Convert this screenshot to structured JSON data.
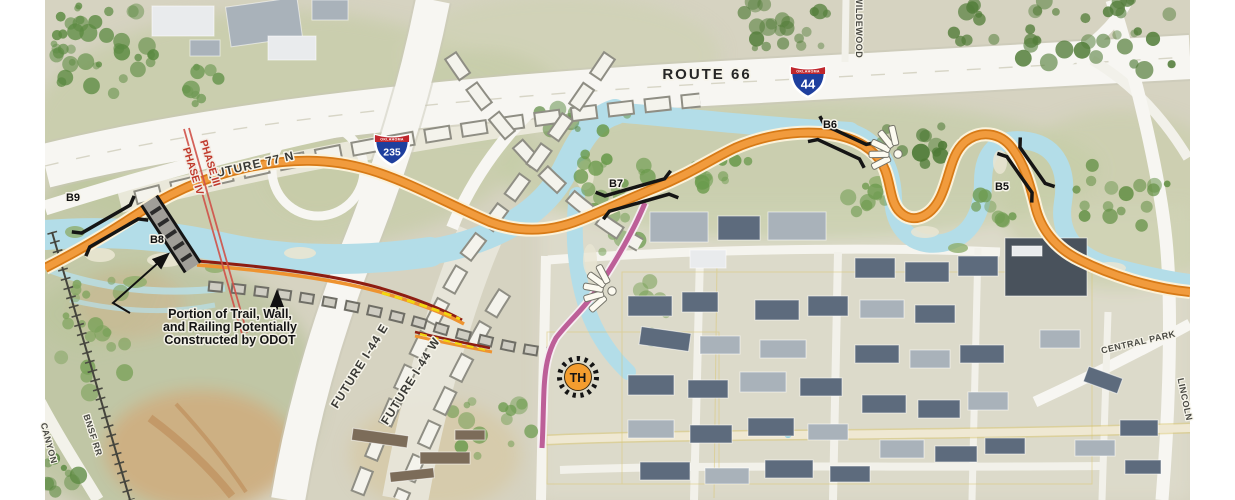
{
  "map": {
    "highways": {
      "route66": "ROUTE 66",
      "i44": {
        "state": "OKLAHOMA",
        "num": "44"
      },
      "i235": {
        "state": "OKLAHOMA",
        "num": "235"
      }
    },
    "future": {
      "f77n": "FUTURE 77 N",
      "i44e": "FUTURE I-44 E",
      "i44w": "FUTURE I-44 W"
    },
    "phases": {
      "p3": "PHASE III",
      "p4": "PHASE IV"
    },
    "bridges": {
      "b5": "B5",
      "b6": "B6",
      "b7": "B7",
      "b8": "B8",
      "b9": "B9"
    },
    "trailhead": "TH",
    "annotation": {
      "l1": "Portion of Trail, Wall,",
      "l2": "and Railing Potentially",
      "l3": "Constructed by ODOT"
    },
    "streets": {
      "wildewood": "WILDEWOOD",
      "centralpark": "CENTRAL PARK",
      "lincoln": "LINCOLN",
      "bnsf": "BNSF RR",
      "canyon": "CANYON"
    },
    "legend_colors": {
      "trail_orange": "#ee9330",
      "trail_pink": "#c0629c",
      "wall_red": "#8e1d12",
      "railing_yellow": "#f2d60f",
      "bridge_black": "#1a1a1a",
      "phase_red": "#c0392b",
      "river_blue": "#b3dde8"
    }
  }
}
